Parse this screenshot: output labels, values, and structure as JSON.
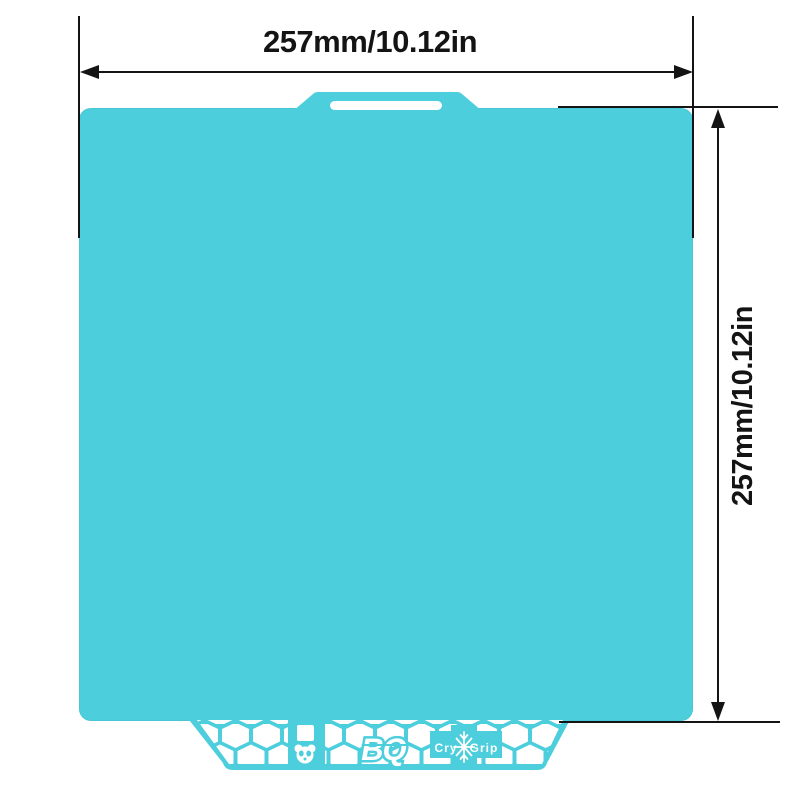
{
  "colors": {
    "plate_teal": "#4CCEDC",
    "line_black": "#141414",
    "background": "#FFFFFF",
    "cutout_white": "#FFFFFF"
  },
  "dimensions": {
    "width": {
      "label": "257mm/10.12in"
    },
    "height": {
      "label": "257mm/10.12in"
    }
  },
  "plate": {
    "brand": {
      "logo": "BQ",
      "cry": "Cry",
      "grip": "Grip"
    }
  }
}
